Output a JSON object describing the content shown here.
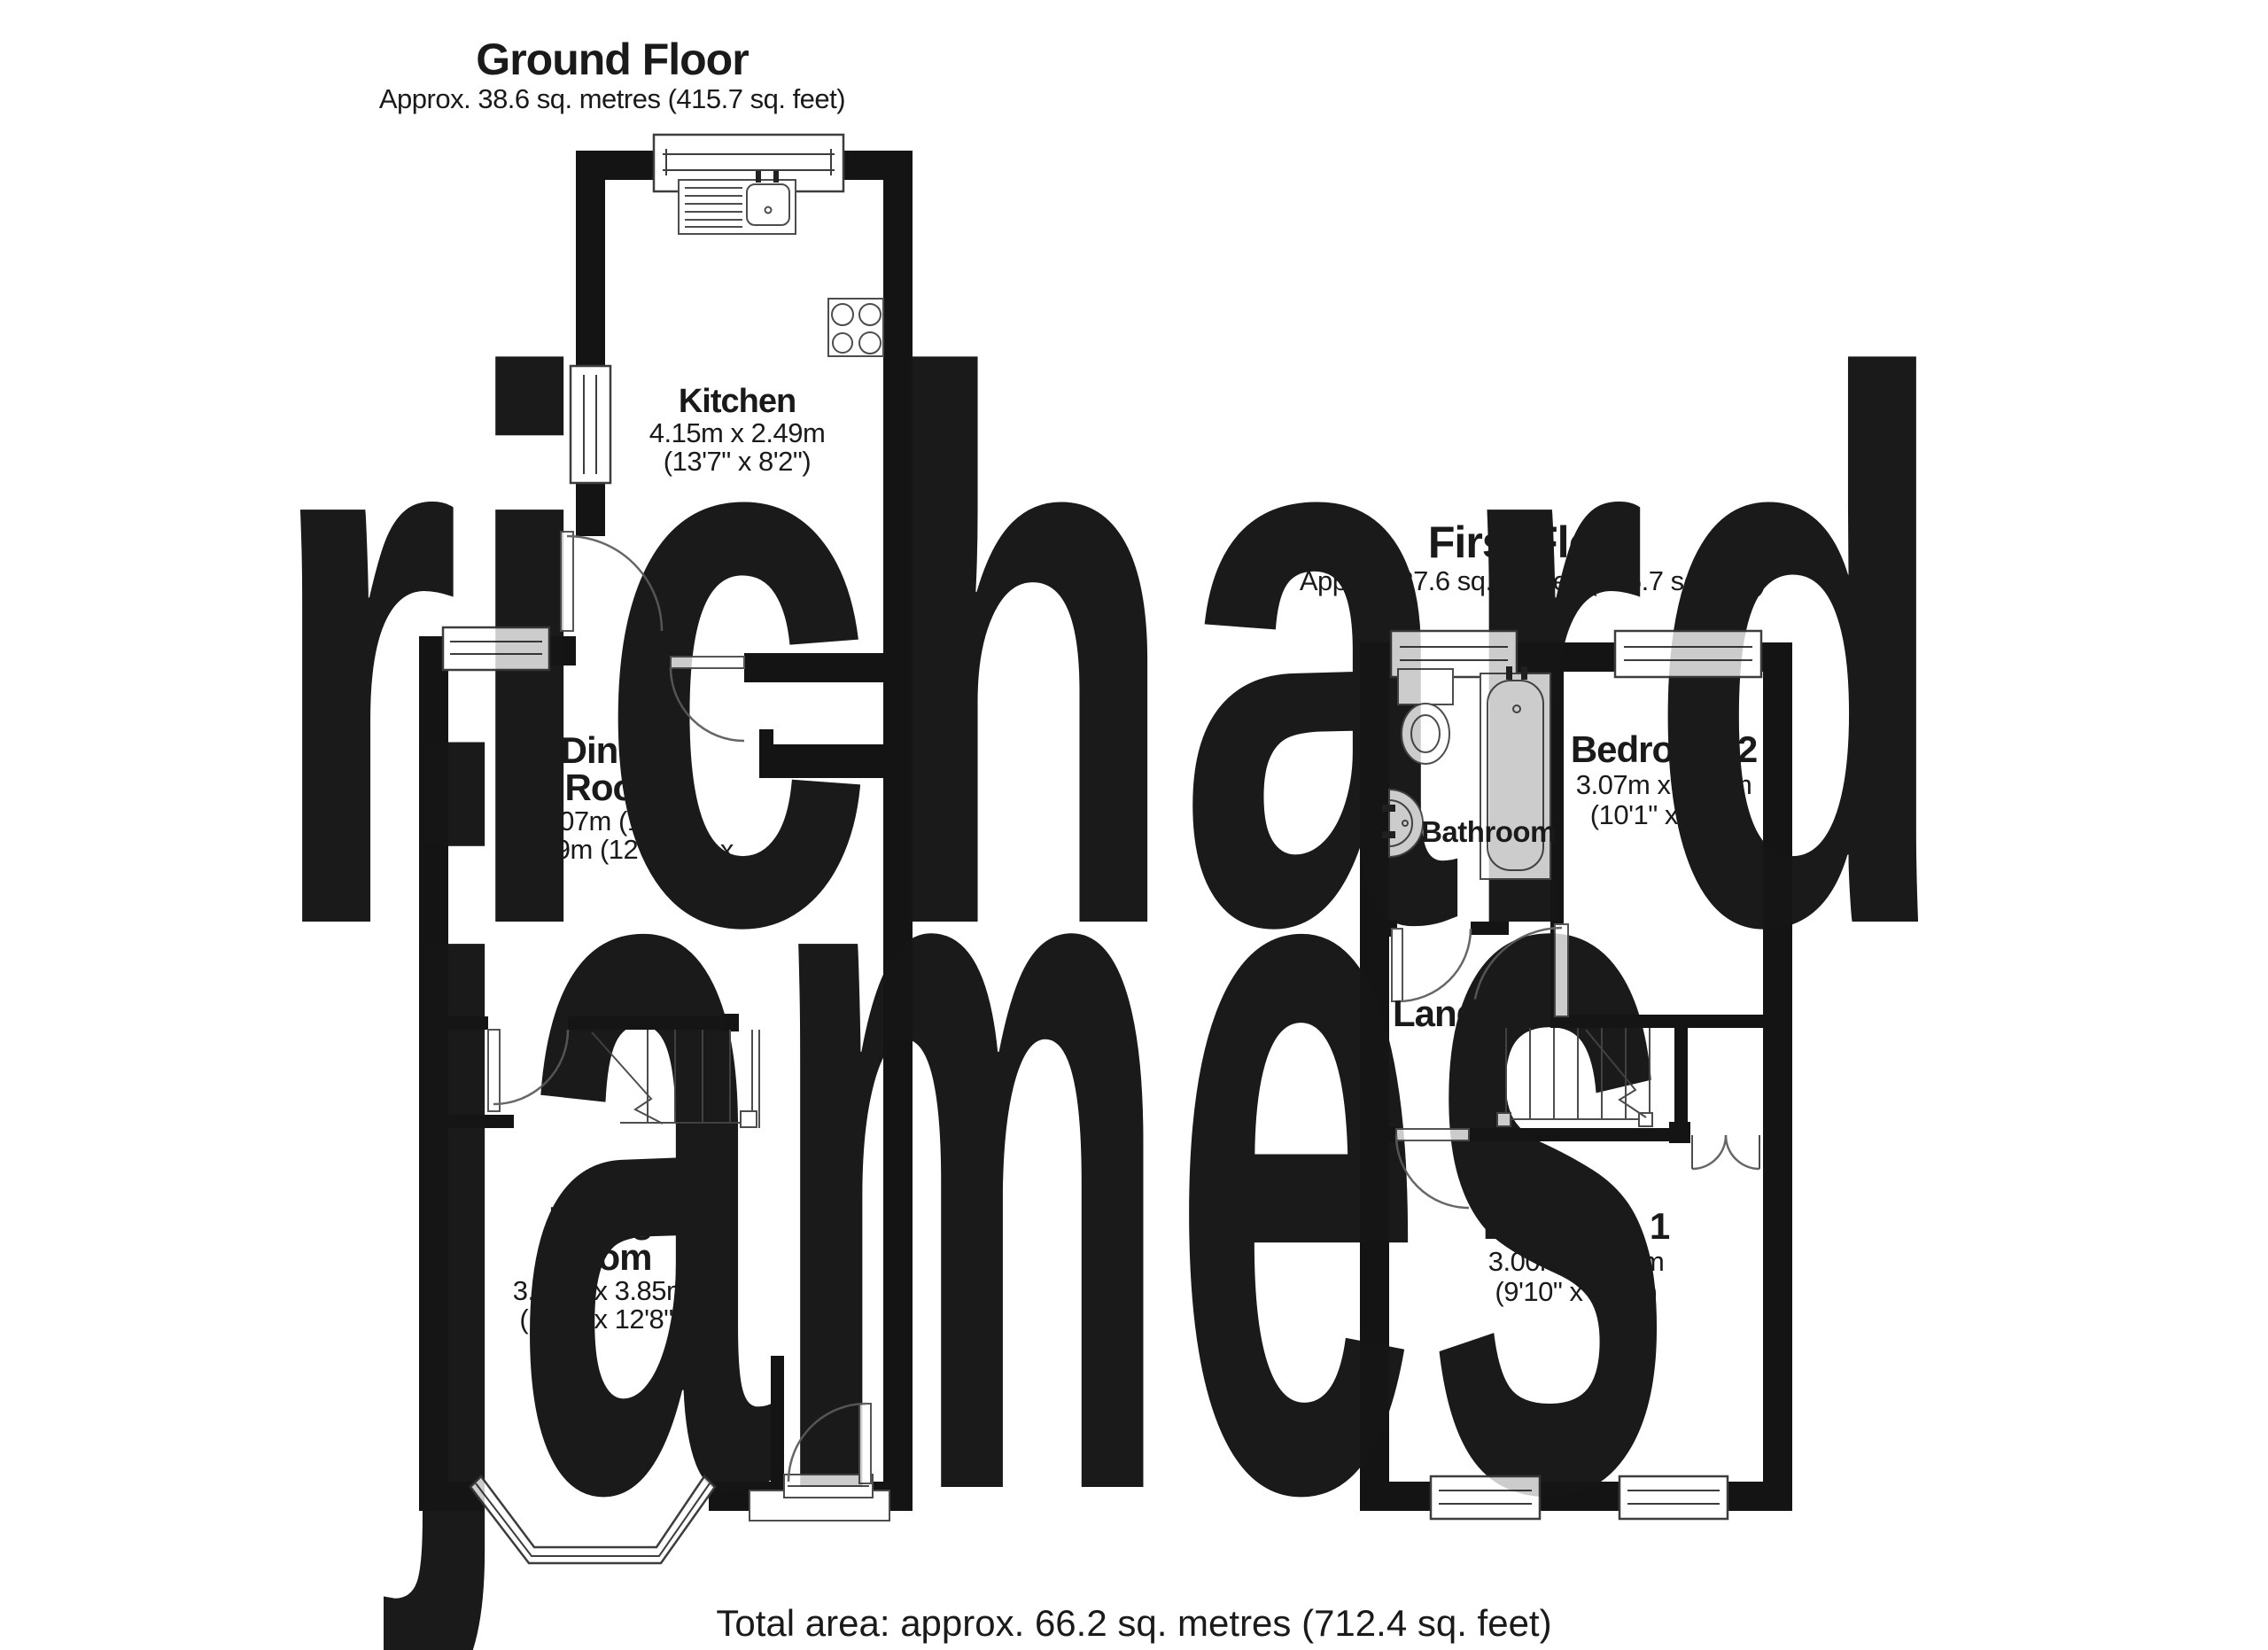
{
  "watermark": {
    "line1": "richard",
    "line2": "james",
    "color": "#dbdbe1"
  },
  "ground_floor": {
    "title": "Ground Floor",
    "subtitle": "Approx. 38.6 sq. metres (415.7 sq. feet)",
    "rooms": {
      "kitchen": {
        "name": "Kitchen",
        "dims_metric": "4.15m x 2.49m",
        "dims_imperial": "(13'7\" x 8'2\")"
      },
      "dining": {
        "name_line1": "Dining",
        "name_line2": "Room",
        "dims_line1": "3.07m (10'1\")",
        "dims_line2": "x 3.89m (12'9\") max"
      },
      "living": {
        "name_line1": "Living",
        "name_line2": "Room",
        "dims_metric": "3.12m x 3.85m",
        "dims_imperial": "(10'3\" x 12'8\")"
      }
    }
  },
  "first_floor": {
    "title": "First Floor",
    "subtitle": "Approx. 27.6 sq. metres (296.7 sq. feet)",
    "rooms": {
      "bathroom": {
        "name": "Bathroom"
      },
      "bedroom2": {
        "name": "Bedroom 2",
        "dims_metric": "3.07m x 2.06m",
        "dims_imperial": "(10'1\" x 6'9\")"
      },
      "landing": {
        "name": "Landing"
      },
      "bedroom1": {
        "name": "Bedroom 1",
        "dims_metric": "3.00m x 3.85m",
        "dims_imperial": "(9'10\" x 12'8\")"
      }
    }
  },
  "footer": {
    "total_area": "Total area: approx. 66.2 sq. metres (712.4 sq. feet)"
  }
}
